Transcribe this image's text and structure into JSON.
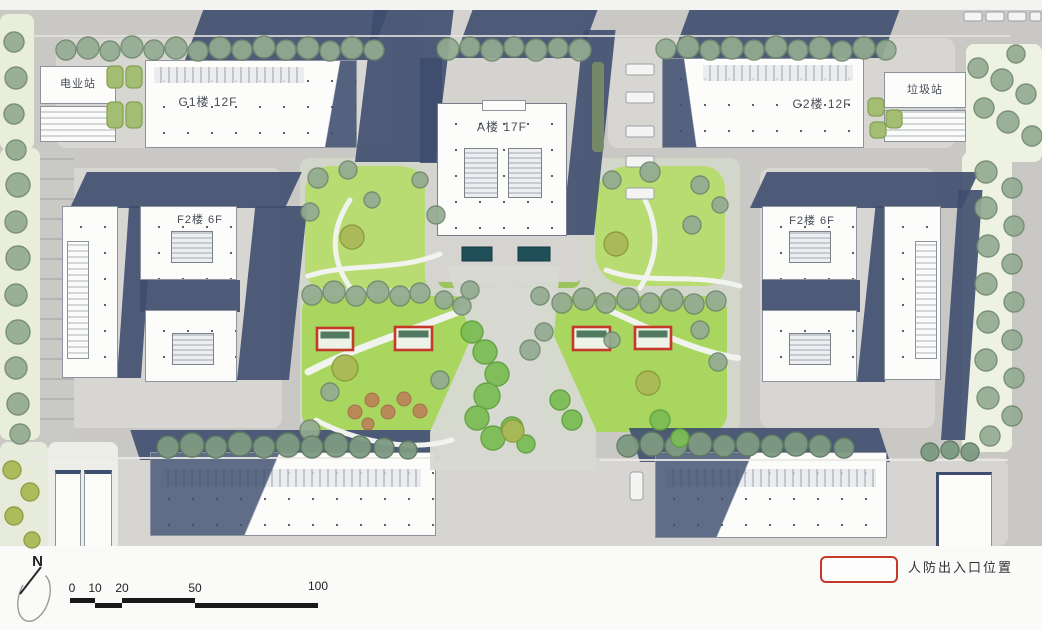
{
  "labels": {
    "power_station": "电业站",
    "building_g1": "G1楼 12F",
    "building_a": "A楼 17F",
    "building_g2": "G2楼 12F",
    "garbage_station": "垃圾站",
    "building_f2_left": "F2楼 6F",
    "building_f2_right": "F2楼 6F",
    "north": "N"
  },
  "legend": {
    "items": [
      {
        "label": "人防出入口位置",
        "symbol": "red-rectangle",
        "color": "#c5392b"
      }
    ]
  },
  "scale_bar": {
    "ticks": [
      "0",
      "10",
      "20",
      "50",
      "100"
    ]
  },
  "markers": {
    "pd_entrance_count": 4,
    "color": "#c5392b"
  },
  "colors": {
    "road": "#c9c8c5",
    "plate": "#d8d6d2",
    "building": "#fcfcfb",
    "shadow_navy": "#3e4d6e",
    "lawn": "#a8d65f",
    "lawn_light": "#b9dc72",
    "tree_sage": "#93ab92",
    "tree_bright": "#7cbd55",
    "tree_olive": "#aab957",
    "pool_teal": "#1f4f58",
    "marker_red": "#c5392b"
  }
}
